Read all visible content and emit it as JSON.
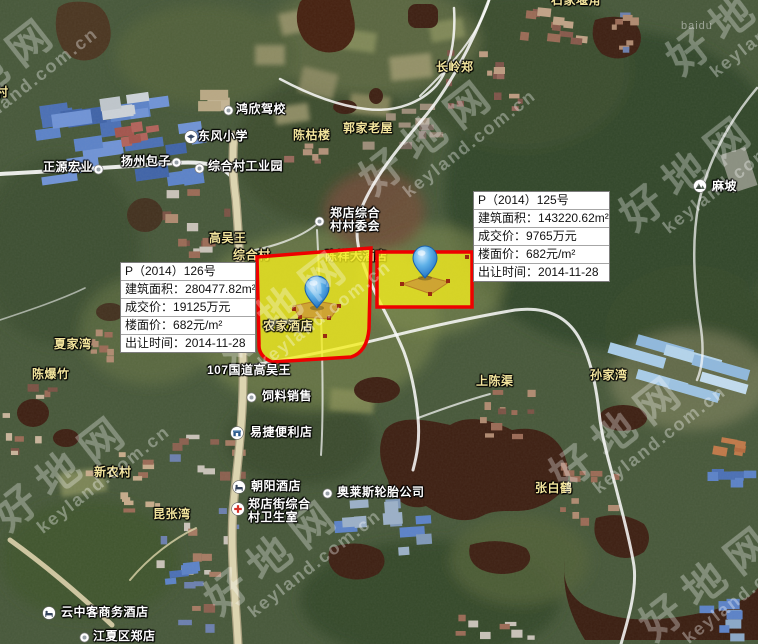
{
  "watermark": {
    "logo_text": "好地网",
    "url_text": "keyland.com.cn",
    "imagery_credit": "baidu"
  },
  "parcels": [
    {
      "title": "P（2014）126号",
      "fields": [
        {
          "label": "建筑面积：",
          "value": "280477.82m²"
        },
        {
          "label": "成交价：",
          "value": "19125万元"
        },
        {
          "label": "楼面价：",
          "value": "682元/m²"
        },
        {
          "label": "出让时间：",
          "value": "2014-11-28"
        }
      ]
    },
    {
      "title": "P（2014）125号",
      "fields": [
        {
          "label": "建筑面积：",
          "value": "143220.62m²"
        },
        {
          "label": "成交价：",
          "value": "9765万元"
        },
        {
          "label": "楼面价：",
          "value": "682元/m²"
        },
        {
          "label": "出让时间：",
          "value": "2014-11-28"
        }
      ]
    }
  ],
  "map": {
    "labels": [
      {
        "text": "村",
        "x": -4,
        "y": 86,
        "type": "village"
      },
      {
        "text": "石家堰角",
        "x": 551,
        "y": -6,
        "type": "village"
      },
      {
        "text": "长岭郑",
        "x": 436,
        "y": 61,
        "type": "village"
      },
      {
        "text": "鸿欣驾校",
        "x": 236,
        "y": 103,
        "type": "poi",
        "icon": "dot",
        "ix": 223,
        "iy": 105
      },
      {
        "text": "东风小学",
        "x": 198,
        "y": 130,
        "type": "poi",
        "icon": "school",
        "ix": 184,
        "iy": 130
      },
      {
        "text": "陈枯楼",
        "x": 293,
        "y": 129,
        "type": "village"
      },
      {
        "text": "郭家老屋",
        "x": 343,
        "y": 122,
        "type": "village"
      },
      {
        "text": "扬州包子",
        "x": 121,
        "y": 155,
        "type": "poi",
        "icon": "dot",
        "ix": 171,
        "iy": 157
      },
      {
        "text": "正源宏业",
        "x": 43,
        "y": 161,
        "type": "poi",
        "icon": "dot",
        "ix": 93,
        "iy": 164
      },
      {
        "text": "综合村工业园",
        "x": 208,
        "y": 160,
        "type": "poi",
        "icon": "dot",
        "ix": 194,
        "iy": 163
      },
      {
        "text": "麻坡",
        "x": 712,
        "y": 180,
        "type": "poi",
        "icon": "mountain",
        "ix": 693,
        "iy": 179
      },
      {
        "text": "郑店综合\n村村委会",
        "x": 330,
        "y": 207,
        "type": "poi",
        "icon": "dot",
        "ix": 314,
        "iy": 216
      },
      {
        "text": "高吴王",
        "x": 209,
        "y": 232,
        "type": "village"
      },
      {
        "text": "综合村",
        "x": 233,
        "y": 249,
        "type": "village",
        "under": true
      },
      {
        "text": "陈祥大酒店",
        "x": 325,
        "y": 250,
        "type": "village",
        "under": true
      },
      {
        "text": "农家酒店",
        "x": 263,
        "y": 320,
        "type": "village"
      },
      {
        "text": "107国道高吴王",
        "x": 207,
        "y": 364,
        "type": "road"
      },
      {
        "text": "夏家湾",
        "x": 54,
        "y": 338,
        "type": "village"
      },
      {
        "text": "陈爆竹",
        "x": 32,
        "y": 368,
        "type": "village"
      },
      {
        "text": "上陈渠",
        "x": 476,
        "y": 375,
        "type": "village"
      },
      {
        "text": "孙家湾",
        "x": 590,
        "y": 369,
        "type": "village"
      },
      {
        "text": "饲料销售",
        "x": 262,
        "y": 390,
        "type": "poi",
        "icon": "dot",
        "ix": 246,
        "iy": 392
      },
      {
        "text": "易捷便利店",
        "x": 250,
        "y": 426,
        "type": "poi",
        "icon": "shop",
        "ix": 230,
        "iy": 426
      },
      {
        "text": "新农村",
        "x": 94,
        "y": 466,
        "type": "village"
      },
      {
        "text": "朝阳酒店",
        "x": 251,
        "y": 480,
        "type": "poi",
        "icon": "hotel",
        "ix": 232,
        "iy": 480
      },
      {
        "text": "张白鹤",
        "x": 535,
        "y": 482,
        "type": "village"
      },
      {
        "text": "奥莱斯轮胎公司",
        "x": 337,
        "y": 486,
        "type": "poi",
        "icon": "dot",
        "ix": 322,
        "iy": 488
      },
      {
        "text": "郑店街综合\n村卫生室",
        "x": 248,
        "y": 498,
        "type": "poi",
        "icon": "hospital",
        "ix": 231,
        "iy": 502
      },
      {
        "text": "昆张湾",
        "x": 153,
        "y": 508,
        "type": "village"
      },
      {
        "text": "云中客商务酒店",
        "x": 61,
        "y": 606,
        "type": "poi",
        "icon": "hotel",
        "ix": 42,
        "iy": 606
      },
      {
        "text": "江夏区郑店",
        "x": 93,
        "y": 630,
        "type": "poi",
        "icon": "dot",
        "ix": 79,
        "iy": 632
      }
    ]
  }
}
